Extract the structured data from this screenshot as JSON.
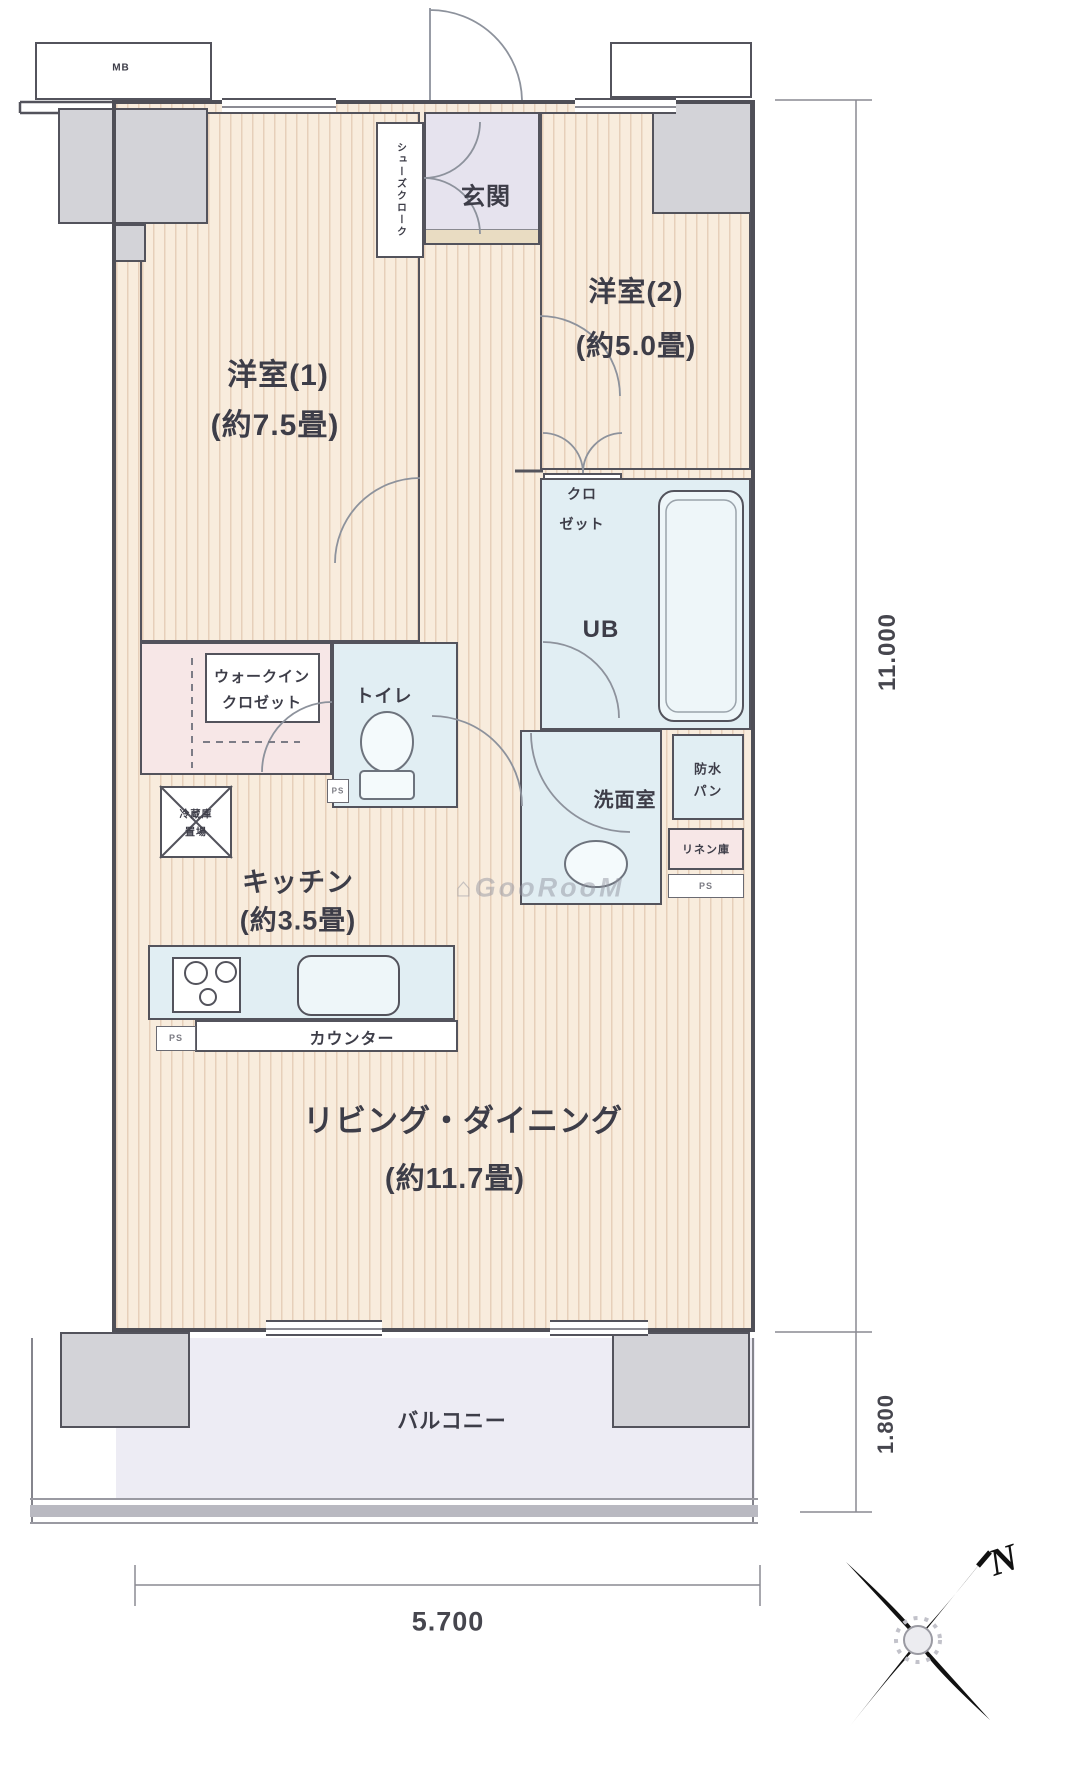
{
  "rooms": {
    "western1": {
      "name": "洋室(1)",
      "size": "(約7.5畳)"
    },
    "western2": {
      "name": "洋室(2)",
      "size": "(約5.0畳)"
    },
    "kitchen": {
      "name": "キッチン",
      "size": "(約3.5畳)"
    },
    "living_dining": {
      "name": "リビング・ダイニング",
      "size": "(約11.7畳)"
    },
    "balcony": {
      "name": "バルコニー"
    },
    "entrance": {
      "name": "玄関"
    },
    "shoe_closet": {
      "name": "シューズクローク"
    },
    "walk_in_closet": {
      "line1": "ウォークイン",
      "line2": "クロゼット"
    },
    "toilet": {
      "name": "トイレ"
    },
    "unit_bath": {
      "name": "UB"
    },
    "closet": {
      "line1": "クロ",
      "line2": "ゼット"
    },
    "washroom": {
      "name": "洗面室"
    },
    "waterproof_pan": {
      "line1": "防水",
      "line2": "パン"
    },
    "linen": {
      "name": "リネン庫"
    },
    "counter": {
      "name": "カウンター"
    },
    "fridge_space": {
      "line1": "冷蔵庫",
      "line2": "置場"
    }
  },
  "small_labels": {
    "meter_box": "MB",
    "ps_toilet": "PS",
    "ps_linen": "PS",
    "ps_counter": "PS"
  },
  "dimensions": {
    "right_total": "11.000",
    "right_balcony": "1.800",
    "bottom_width": "5.700"
  },
  "compass": {
    "north": "N"
  },
  "watermark": {
    "text": "⌂GooRooM"
  },
  "colors": {
    "flooring": "#f8ecdd",
    "flooring_stripe": "#c8a080",
    "wet_area": "#e1eef3",
    "closet_pink": "#f7e7e7",
    "entrance_lavender": "#e6e3ee",
    "balcony": "#edecf4",
    "pillar_gray": "#d3d3d8",
    "wall": "#4f4f57",
    "text": "#3d3d48"
  }
}
